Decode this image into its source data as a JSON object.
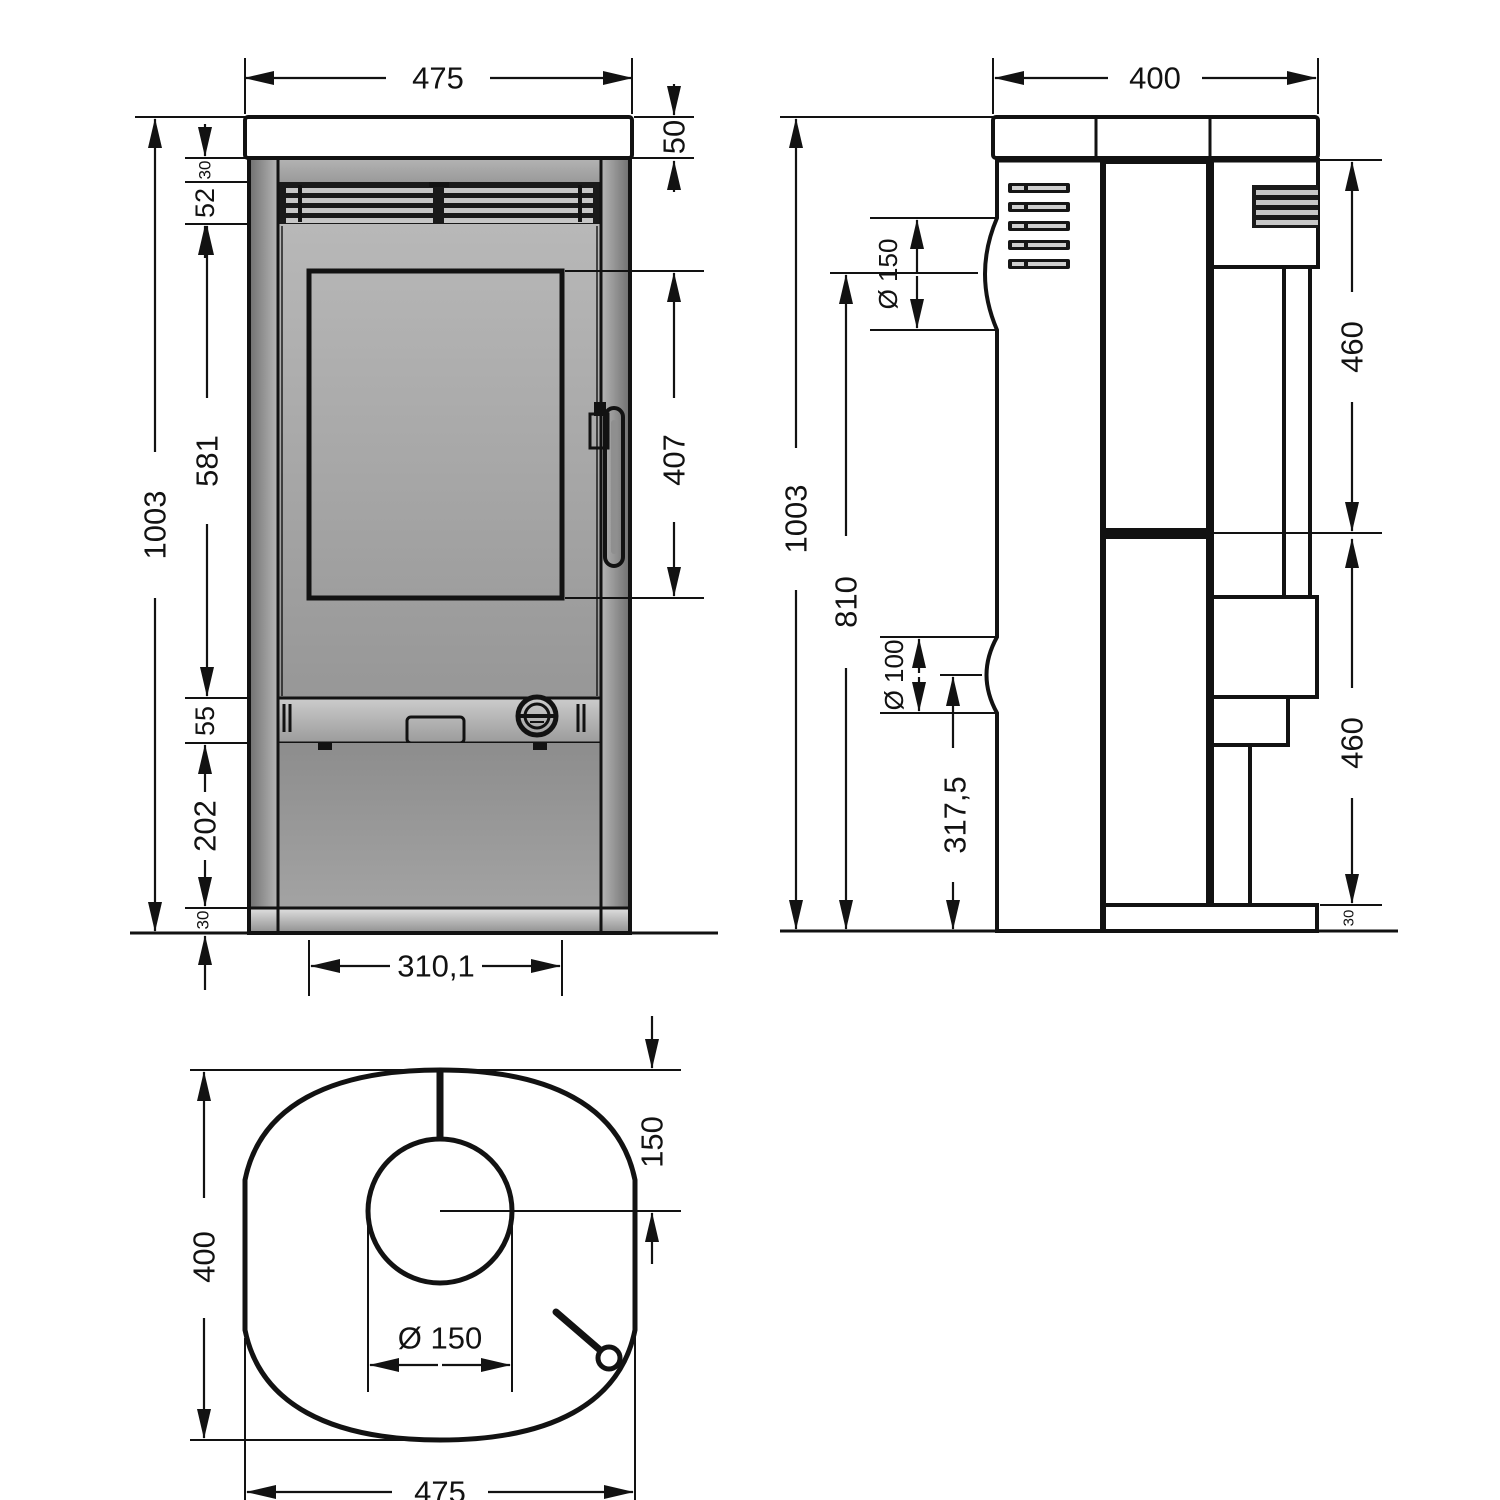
{
  "drawing": {
    "type": "technical-dimension-drawing",
    "subject": "free-standing stove, three orthographic views",
    "views": {
      "front": {
        "name": "Front view",
        "dims": {
          "overall_width": "475",
          "top_plate_height": "50",
          "top_gap": "30",
          "grille_height": "52",
          "overall_height": "1003",
          "upper_body": "581",
          "door_glass_height": "407",
          "control_band": "55",
          "lower_panel": "202",
          "base_height": "30",
          "inner_width": "310,1"
        }
      },
      "side": {
        "name": "Side view",
        "dims": {
          "overall_depth": "400",
          "overall_height": "1003",
          "flue_center_height": "810",
          "flue_diameter": "Ø 150",
          "air_inlet_diameter": "Ø 100",
          "air_inlet_center_height": "317,5",
          "upper_panel": "460",
          "lower_panel": "460",
          "base_height": "30"
        }
      },
      "top": {
        "name": "Top view",
        "dims": {
          "overall_depth": "400",
          "flue_center_from_back": "150",
          "flue_diameter": "Ø 150",
          "overall_width": "475"
        }
      }
    },
    "colors": {
      "line": "#121212",
      "body_gray": "#a5a5a5",
      "light_gray": "#e3e3e3",
      "dark_gray": "#6e6e6e",
      "background": "#ffffff"
    }
  }
}
